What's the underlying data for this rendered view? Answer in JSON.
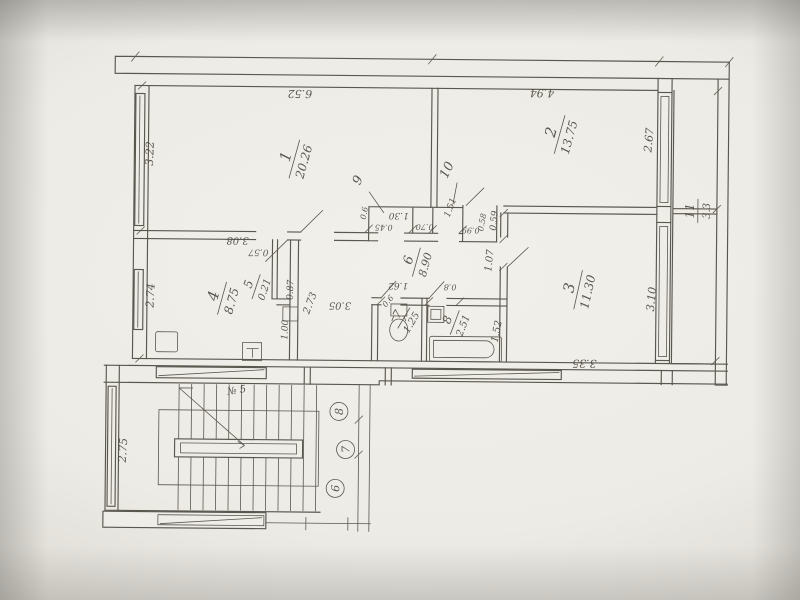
{
  "plan": {
    "colors": {
      "ink": "#5a574f",
      "text": "#4e4b44",
      "paper": "#efede8"
    },
    "rooms": [
      {
        "n": "1",
        "area": "20.26",
        "x": 293,
        "y": 160,
        "rot": -75,
        "fs": 15,
        "afs": 12,
        "lw": 20
      },
      {
        "n": "2",
        "area": "13.75",
        "x": 558,
        "y": 133,
        "rot": -75,
        "fs": 15,
        "afs": 12,
        "lw": 20
      },
      {
        "n": "3",
        "area": "11.30",
        "x": 578,
        "y": 288,
        "rot": -78,
        "fs": 15,
        "afs": 12,
        "lw": 20
      },
      {
        "n": "4",
        "area": "8.75",
        "x": 222,
        "y": 300,
        "rot": -75,
        "fs": 15,
        "afs": 12,
        "lw": 17
      },
      {
        "n": "5",
        "area": "0.21",
        "x": 256,
        "y": 288,
        "rot": -72,
        "fs": 12,
        "afs": 10,
        "lw": 13
      },
      {
        "n": "6",
        "area": "8.90",
        "x": 416,
        "y": 262,
        "rot": -75,
        "fs": 13,
        "afs": 11,
        "lw": 15
      },
      {
        "n": "7",
        "area": "1.25",
        "x": 404,
        "y": 318,
        "rot": -60,
        "fs": 11,
        "afs": 10,
        "lw": 12
      },
      {
        "n": "8",
        "area": "2.51",
        "x": 455,
        "y": 322,
        "rot": -70,
        "fs": 12,
        "afs": 10,
        "lw": 13
      },
      {
        "n": "9",
        "area": null,
        "x": 364,
        "y": 184,
        "rot": -65,
        "fs": 13
      },
      {
        "n": "10",
        "area": null,
        "x": 453,
        "y": 173,
        "rot": -65,
        "fs": 13
      },
      {
        "n": "11",
        "area": "3.3",
        "x": 697,
        "y": 208,
        "rot": -90,
        "fs": 12,
        "afs": 10,
        "lw": 12
      }
    ],
    "dims": [
      {
        "t": "6.52",
        "x": 298,
        "y": 91,
        "rot": 180,
        "fs": 11
      },
      {
        "t": "4.94",
        "x": 540,
        "y": 88,
        "rot": 180,
        "fs": 11
      },
      {
        "t": "3.22",
        "x": 152,
        "y": 156,
        "rot": -88,
        "fs": 11
      },
      {
        "t": "2.74",
        "x": 154,
        "y": 298,
        "rot": -88,
        "fs": 11
      },
      {
        "t": "3.08",
        "x": 237,
        "y": 239,
        "rot": 180,
        "fs": 10
      },
      {
        "t": "3.05",
        "x": 340,
        "y": 303,
        "rot": 180,
        "fs": 10
      },
      {
        "t": "2.73",
        "x": 313,
        "y": 305,
        "rot": -70,
        "fs": 10
      },
      {
        "t": "1.00",
        "x": 288,
        "y": 331,
        "rot": -88,
        "fs": 9
      },
      {
        "t": "0.57",
        "x": 258,
        "y": 251,
        "rot": 180,
        "fs": 9
      },
      {
        "t": "0.87",
        "x": 293,
        "y": 291,
        "rot": -88,
        "fs": 9
      },
      {
        "t": "0.6",
        "x": 366,
        "y": 214,
        "rot": -80,
        "fs": 8
      },
      {
        "t": "1.30",
        "x": 398,
        "y": 213,
        "rot": 180,
        "fs": 9
      },
      {
        "t": "0.45",
        "x": 383,
        "y": 225,
        "rot": 180,
        "fs": 8
      },
      {
        "t": "0.70",
        "x": 424,
        "y": 224,
        "rot": 180,
        "fs": 8
      },
      {
        "t": "1.51",
        "x": 452,
        "y": 208,
        "rot": -70,
        "fs": 9
      },
      {
        "t": "0.99",
        "x": 470,
        "y": 227,
        "rot": 180,
        "fs": 8
      },
      {
        "t": "0.58",
        "x": 484,
        "y": 222,
        "rot": -80,
        "fs": 8
      },
      {
        "t": "0.59",
        "x": 496,
        "y": 220,
        "rot": -85,
        "fs": 9
      },
      {
        "t": "1.07",
        "x": 492,
        "y": 260,
        "rot": -85,
        "fs": 10
      },
      {
        "t": "1.52",
        "x": 500,
        "y": 331,
        "rot": -80,
        "fs": 10
      },
      {
        "t": "3.35",
        "x": 585,
        "y": 358,
        "rot": 180,
        "fs": 11
      },
      {
        "t": "2.67",
        "x": 651,
        "y": 138,
        "rot": -85,
        "fs": 11
      },
      {
        "t": "3.10",
        "x": 655,
        "y": 297,
        "rot": -85,
        "fs": 11
      },
      {
        "t": "1.62",
        "x": 398,
        "y": 283,
        "rot": 180,
        "fs": 9
      },
      {
        "t": "0.8",
        "x": 450,
        "y": 284,
        "rot": 180,
        "fs": 8
      },
      {
        "t": "0.6",
        "x": 390,
        "y": 303,
        "rot": -50,
        "fs": 8
      },
      {
        "t": "2.75",
        "x": 128,
        "y": 453,
        "rot": -87,
        "fs": 11
      }
    ],
    "axis_circles": [
      {
        "t": "8",
        "x": 340,
        "y": 412
      },
      {
        "t": "7",
        "x": 347,
        "y": 450
      },
      {
        "t": "6",
        "x": 337,
        "y": 489
      }
    ],
    "annotations": [
      {
        "t": "№ 5",
        "x": 238,
        "y": 395,
        "rot": -10,
        "fs": 10
      }
    ]
  }
}
